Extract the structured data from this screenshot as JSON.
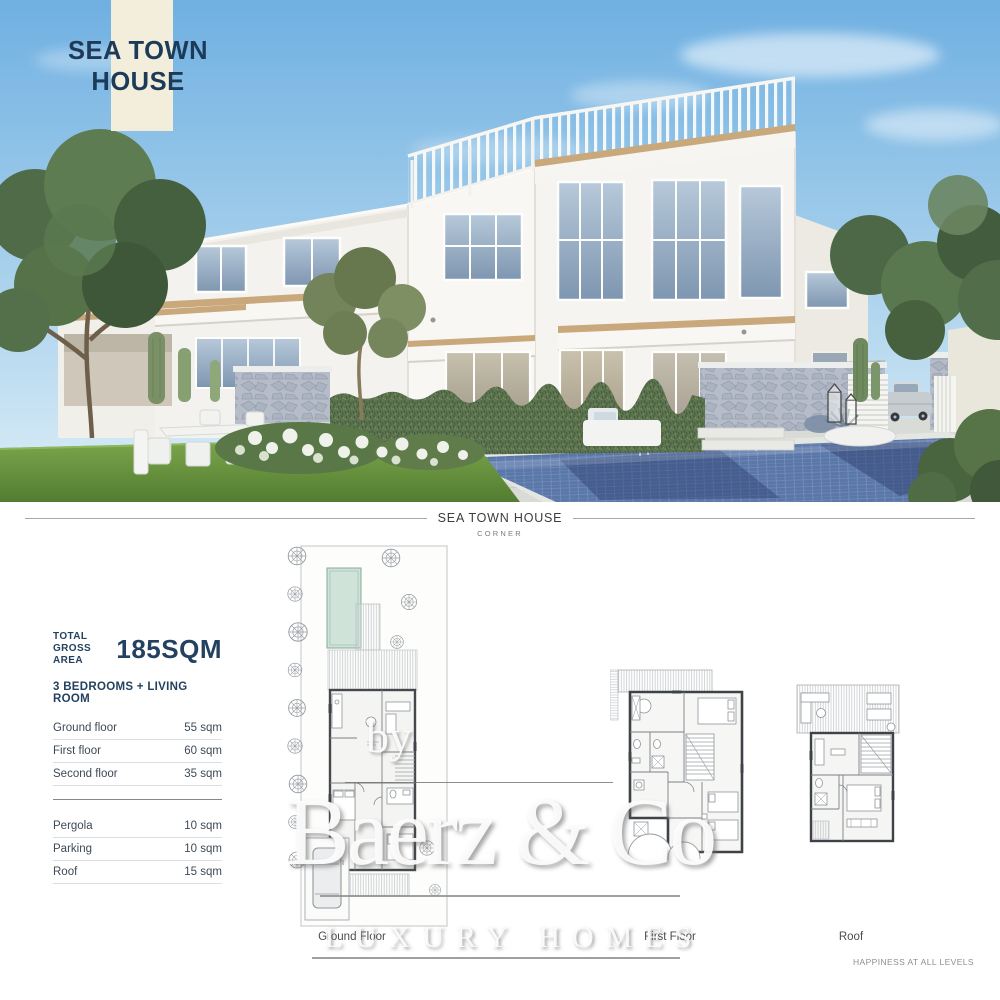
{
  "hero": {
    "title_line1": "SEA TOWN",
    "title_line2": "HOUSE"
  },
  "section_header": {
    "title": "SEA TOWN HOUSE",
    "subtitle": "CORNER"
  },
  "specs": {
    "total_label_line1": "TOTAL",
    "total_label_line2": "GROSS AREA",
    "total_value": "185SQM",
    "bedrooms_line": "3 BEDROOMS + LIVING ROOM",
    "rows_main": [
      {
        "label": "Ground floor",
        "value": "55 sqm"
      },
      {
        "label": "First floor",
        "value": "60 sqm"
      },
      {
        "label": "Second floor",
        "value": "35 sqm"
      }
    ],
    "rows_extra": [
      {
        "label": "Pergola",
        "value": "10 sqm"
      },
      {
        "label": "Parking",
        "value": "10 sqm"
      },
      {
        "label": "Roof",
        "value": "15 sqm"
      }
    ]
  },
  "floorplans": [
    {
      "label": "Ground Floor"
    },
    {
      "label": "First Floor"
    },
    {
      "label": "Roof"
    }
  ],
  "watermark": {
    "by": "by",
    "brand": "Baerz & Co",
    "tagline": "LUXURY HOMES"
  },
  "footer": {
    "tagline": "HAPPINESS AT ALL LEVELS"
  },
  "colors": {
    "navy": "#24425f",
    "cream": "#f2eedb",
    "wood_accent": "#c9a87c",
    "hedge_green": "#5d7450",
    "pool_tile_blue": "#5a77a8",
    "plan_pool_teal": "#cfe3d9",
    "watermark_gray": "#8f8f8f"
  }
}
